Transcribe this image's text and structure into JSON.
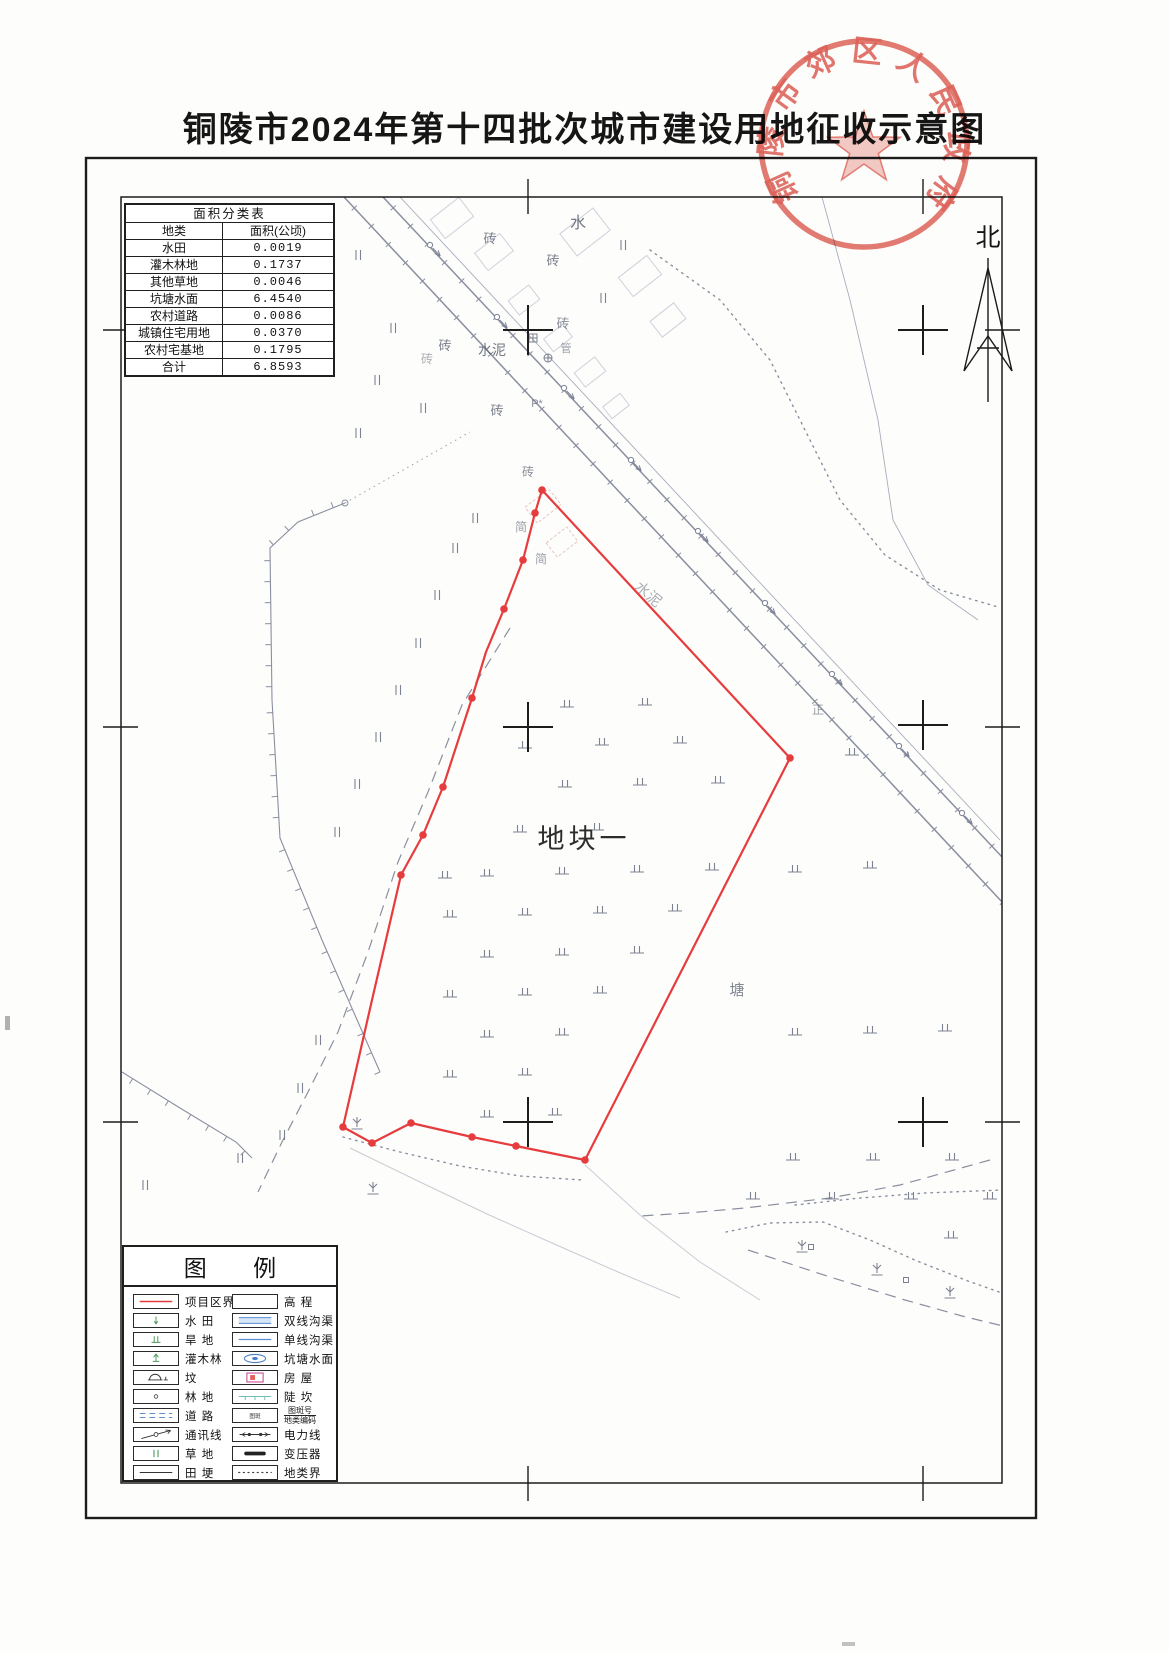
{
  "title": "铜陵市2024年第十四批次城市建设用地征收示意图",
  "seal": {
    "text": "铜陵市郊区人民政府",
    "color": "#d95248"
  },
  "north": {
    "label": "北"
  },
  "area_table": {
    "title": "面积分类表",
    "columns": [
      "地类",
      "面积(公顷)"
    ],
    "rows": [
      [
        "水田",
        "0.0019"
      ],
      [
        "灌木林地",
        "0.1737"
      ],
      [
        "其他草地",
        "0.0046"
      ],
      [
        "坑塘水面",
        "6.4540"
      ],
      [
        "农村道路",
        "0.0086"
      ],
      [
        "城镇住宅用地",
        "0.0370"
      ],
      [
        "农村宅基地",
        "0.1795"
      ],
      [
        "合计",
        "6.8593"
      ]
    ]
  },
  "legend": {
    "title": "图  例",
    "left_items": [
      {
        "symbol": "project-boundary",
        "label": "项目区界线"
      },
      {
        "symbol": "paddy",
        "label": "水 田"
      },
      {
        "symbol": "dryland",
        "label": "旱 地"
      },
      {
        "symbol": "shrub",
        "label": "灌木林"
      },
      {
        "symbol": "grave",
        "label": "坟"
      },
      {
        "symbol": "forest",
        "label": "林 地"
      },
      {
        "symbol": "road",
        "label": "道 路"
      },
      {
        "symbol": "telecom",
        "label": "通讯线"
      },
      {
        "symbol": "grass",
        "label": "草 地"
      },
      {
        "symbol": "ridge",
        "label": "田 埂"
      }
    ],
    "right_items": [
      {
        "symbol": "elevation",
        "label": "高 程"
      },
      {
        "symbol": "double-ditch",
        "label": "双线沟渠"
      },
      {
        "symbol": "single-ditch",
        "label": "单线沟渠"
      },
      {
        "symbol": "pond",
        "label": "坑塘水面"
      },
      {
        "symbol": "house",
        "label": "房 屋"
      },
      {
        "symbol": "scarp",
        "label": "陡 坎"
      },
      {
        "symbol": "spot-number",
        "label": "图斑号/地类编码",
        "fraction": true
      },
      {
        "symbol": "power-line",
        "label": "电力线"
      },
      {
        "symbol": "transformer",
        "label": "变压器"
      },
      {
        "symbol": "boundary",
        "label": "地类界"
      }
    ]
  },
  "map": {
    "plot_label": {
      "text": "地块一",
      "x": 584,
      "y": 848
    },
    "red_polygon": [
      [
        542,
        490
      ],
      [
        790,
        758
      ],
      [
        585,
        1160
      ],
      [
        516,
        1146
      ],
      [
        472,
        1137
      ],
      [
        411,
        1123
      ],
      [
        372,
        1143
      ],
      [
        343,
        1127
      ],
      [
        372,
        1000
      ],
      [
        401,
        875
      ],
      [
        423,
        835
      ],
      [
        443,
        787
      ],
      [
        472,
        698
      ],
      [
        486,
        652
      ],
      [
        504,
        609
      ],
      [
        523,
        560
      ],
      [
        535,
        513
      ]
    ],
    "vertex_dots": [
      [
        542,
        490
      ],
      [
        535,
        513
      ],
      [
        523,
        560
      ],
      [
        504,
        609
      ],
      [
        472,
        698
      ],
      [
        443,
        787
      ],
      [
        423,
        835
      ],
      [
        401,
        875
      ],
      [
        343,
        1127
      ],
      [
        372,
        1143
      ],
      [
        411,
        1123
      ],
      [
        472,
        1137
      ],
      [
        516,
        1146
      ],
      [
        585,
        1160
      ],
      [
        790,
        758
      ]
    ],
    "grid_crosses": [
      [
        528,
        330
      ],
      [
        923,
        330
      ],
      [
        528,
        727
      ],
      [
        923,
        725
      ],
      [
        528,
        1122
      ],
      [
        923,
        1122
      ]
    ],
    "labels": [
      {
        "t": "水",
        "x": 578,
        "y": 228,
        "s": 16,
        "o": 0.85
      },
      {
        "t": "砖",
        "x": 490,
        "y": 243,
        "s": 13,
        "o": 0.8
      },
      {
        "t": "砖",
        "x": 553,
        "y": 265,
        "s": 13,
        "o": 0.8
      },
      {
        "t": "砖",
        "x": 563,
        "y": 328,
        "s": 13,
        "o": 0.7
      },
      {
        "t": "砖",
        "x": 445,
        "y": 350,
        "s": 13,
        "o": 0.8
      },
      {
        "t": "砖",
        "x": 427,
        "y": 363,
        "s": 12,
        "o": 0.5
      },
      {
        "t": "砖",
        "x": 497,
        "y": 415,
        "s": 13,
        "o": 0.8
      },
      {
        "t": "水泥",
        "x": 492,
        "y": 355,
        "s": 14,
        "o": 0.85
      },
      {
        "t": "管",
        "x": 566,
        "y": 352,
        "s": 11,
        "o": 0.6
      },
      {
        "t": "P*",
        "x": 537,
        "y": 407,
        "s": 11,
        "o": 0.7
      },
      {
        "t": "砖",
        "x": 528,
        "y": 476,
        "s": 12,
        "o": 0.7
      },
      {
        "t": "简",
        "x": 521,
        "y": 531,
        "s": 12,
        "o": 0.6
      },
      {
        "t": "简",
        "x": 541,
        "y": 563,
        "s": 12,
        "o": 0.6
      },
      {
        "t": "水泥",
        "x": 645,
        "y": 598,
        "s": 15,
        "o": 0.5,
        "r": 40
      },
      {
        "t": "塘",
        "x": 737,
        "y": 995,
        "s": 15,
        "o": 0.75
      },
      {
        "t": "正",
        "x": 818,
        "y": 714,
        "s": 12,
        "o": 0.6
      }
    ],
    "dryland_symbols": [
      [
        567,
        707
      ],
      [
        645,
        705
      ],
      [
        525,
        748
      ],
      [
        602,
        745
      ],
      [
        680,
        743
      ],
      [
        565,
        787
      ],
      [
        640,
        785
      ],
      [
        718,
        783
      ],
      [
        520,
        832
      ],
      [
        597,
        830
      ],
      [
        445,
        878
      ],
      [
        487,
        876
      ],
      [
        562,
        874
      ],
      [
        637,
        872
      ],
      [
        712,
        870
      ],
      [
        450,
        917
      ],
      [
        525,
        915
      ],
      [
        600,
        913
      ],
      [
        675,
        911
      ],
      [
        487,
        957
      ],
      [
        562,
        955
      ],
      [
        637,
        953
      ],
      [
        450,
        997
      ],
      [
        525,
        995
      ],
      [
        600,
        993
      ],
      [
        487,
        1037
      ],
      [
        562,
        1035
      ],
      [
        450,
        1077
      ],
      [
        525,
        1075
      ],
      [
        487,
        1117
      ],
      [
        555,
        1115
      ],
      [
        852,
        755
      ],
      [
        795,
        872
      ],
      [
        870,
        868
      ],
      [
        793,
        1160
      ],
      [
        873,
        1160
      ],
      [
        952,
        1160
      ],
      [
        753,
        1199
      ],
      [
        832,
        1199
      ],
      [
        911,
        1199
      ],
      [
        990,
        1199
      ],
      [
        951,
        1238
      ],
      [
        795,
        1035
      ],
      [
        870,
        1033
      ],
      [
        945,
        1031
      ]
    ],
    "grass_symbols": [
      [
        358,
        255
      ],
      [
        393,
        328
      ],
      [
        377,
        380
      ],
      [
        423,
        408
      ],
      [
        358,
        433
      ],
      [
        623,
        245
      ],
      [
        603,
        298
      ],
      [
        475,
        518
      ],
      [
        455,
        548
      ],
      [
        437,
        595
      ],
      [
        418,
        643
      ],
      [
        398,
        690
      ],
      [
        378,
        737
      ],
      [
        357,
        784
      ],
      [
        337,
        832
      ],
      [
        318,
        1040
      ],
      [
        300,
        1088
      ],
      [
        282,
        1135
      ],
      [
        240,
        1158
      ],
      [
        145,
        1185
      ]
    ],
    "shrub_symbols": [
      [
        357,
        1125
      ],
      [
        373,
        1190
      ],
      [
        802,
        1248
      ],
      [
        877,
        1271
      ],
      [
        950,
        1294
      ]
    ],
    "square_symbols": [
      [
        811,
        1247
      ],
      [
        906,
        1280
      ]
    ],
    "crossed_square_symbols": [
      [
        533,
        338
      ]
    ],
    "crossed_circle_symbols": [
      [
        548,
        358
      ]
    ],
    "buildings": [
      [
        452,
        218,
        36,
        24
      ],
      [
        494,
        252,
        32,
        22
      ],
      [
        585,
        232,
        42,
        28
      ],
      [
        640,
        276,
        36,
        24
      ],
      [
        668,
        320,
        30,
        20
      ],
      [
        524,
        300,
        26,
        18
      ],
      [
        558,
        338,
        24,
        16
      ],
      [
        590,
        372,
        26,
        18
      ],
      [
        616,
        406,
        22,
        15
      ]
    ],
    "sheds": [
      [
        543,
        506,
        30,
        20
      ],
      [
        562,
        542,
        26,
        18
      ]
    ],
    "paths": [
      {
        "pts": [
          [
            383,
            197
          ],
          [
            1003,
            858
          ]
        ],
        "cls": "road",
        "ticks": true
      },
      {
        "pts": [
          [
            344,
            197
          ],
          [
            1003,
            903
          ]
        ],
        "cls": "road",
        "ticks": true
      },
      {
        "pts": [
          [
            400,
            197
          ],
          [
            1000,
            840
          ]
        ],
        "cls": "thin"
      },
      {
        "pts": [
          [
            345,
            503
          ],
          [
            298,
            522
          ],
          [
            270,
            548
          ],
          [
            272,
            700
          ],
          [
            280,
            838
          ],
          [
            322,
            940
          ],
          [
            358,
            1022
          ],
          [
            380,
            1072
          ]
        ],
        "cls": "bound",
        "sideticks": true
      },
      {
        "pts": [
          [
            345,
            503
          ],
          [
            470,
            432
          ]
        ],
        "cls": "dashdot"
      },
      {
        "pts": [
          [
            122,
            1072
          ],
          [
            180,
            1108
          ],
          [
            236,
            1142
          ],
          [
            252,
            1158
          ]
        ],
        "cls": "bound",
        "sideticks": true
      },
      {
        "pts": [
          [
            510,
            628
          ],
          [
            462,
            705
          ],
          [
            428,
            792
          ],
          [
            398,
            862
          ],
          [
            368,
            952
          ],
          [
            338,
            1032
          ],
          [
            308,
            1092
          ],
          [
            282,
            1142
          ],
          [
            258,
            1192
          ]
        ],
        "cls": "dash"
      },
      {
        "pts": [
          [
            990,
            1160
          ],
          [
            900,
            1185
          ],
          [
            830,
            1198
          ],
          [
            745,
            1208
          ],
          [
            688,
            1213
          ],
          [
            640,
            1216
          ]
        ],
        "cls": "dash"
      },
      {
        "pts": [
          [
            748,
            1250
          ],
          [
            830,
            1277
          ],
          [
            905,
            1300
          ],
          [
            962,
            1316
          ],
          [
            1003,
            1326
          ]
        ],
        "cls": "dash"
      },
      {
        "pts": [
          [
            350,
            1148
          ],
          [
            420,
            1182
          ],
          [
            487,
            1214
          ],
          [
            552,
            1243
          ],
          [
            618,
            1272
          ],
          [
            680,
            1298
          ]
        ],
        "cls": "faint"
      },
      {
        "pts": [
          [
            585,
            1165
          ],
          [
            640,
            1215
          ],
          [
            700,
            1262
          ],
          [
            760,
            1300
          ]
        ],
        "cls": "faint"
      },
      {
        "pts": [
          [
            822,
            197
          ],
          [
            850,
            300
          ],
          [
            878,
            420
          ],
          [
            893,
            520
          ],
          [
            928,
            585
          ],
          [
            978,
            620
          ]
        ],
        "cls": "thin"
      },
      {
        "pts": [
          [
            650,
            250
          ],
          [
            720,
            300
          ],
          [
            770,
            360
          ],
          [
            805,
            430
          ],
          [
            840,
            500
          ],
          [
            885,
            555
          ],
          [
            940,
            590
          ],
          [
            998,
            607
          ]
        ],
        "cls": "dotted"
      },
      {
        "pts": [
          [
            343,
            1137
          ],
          [
            400,
            1152
          ],
          [
            460,
            1166
          ],
          [
            520,
            1176
          ],
          [
            583,
            1180
          ]
        ],
        "cls": "dotted"
      },
      {
        "pts": [
          [
            795,
            1205
          ],
          [
            860,
            1198
          ],
          [
            925,
            1193
          ],
          [
            1002,
            1190
          ]
        ],
        "cls": "dotted"
      },
      {
        "pts": [
          [
            726,
            1232
          ],
          [
            770,
            1223
          ],
          [
            823,
            1222
          ],
          [
            870,
            1240
          ],
          [
            917,
            1261
          ],
          [
            968,
            1281
          ],
          [
            1002,
            1293
          ]
        ],
        "cls": "dotted"
      }
    ],
    "power_glyphs": [
      [
        430,
        245
      ],
      [
        497,
        317
      ],
      [
        564,
        388
      ],
      [
        631,
        460
      ],
      [
        698,
        531
      ],
      [
        765,
        603
      ],
      [
        832,
        674
      ],
      [
        899,
        746
      ],
      [
        962,
        813
      ]
    ]
  },
  "colors": {
    "boundary_red": "#e63c3e",
    "seal_red": "#d95248",
    "map_gray": "#8a8fa0",
    "ditch_blue": "#5b8fd0",
    "veg_green": "#4a9a57",
    "scarp_teal": "#6fc0b8",
    "house_magenta": "#c84a96",
    "ink_black": "#1f1f1f"
  }
}
